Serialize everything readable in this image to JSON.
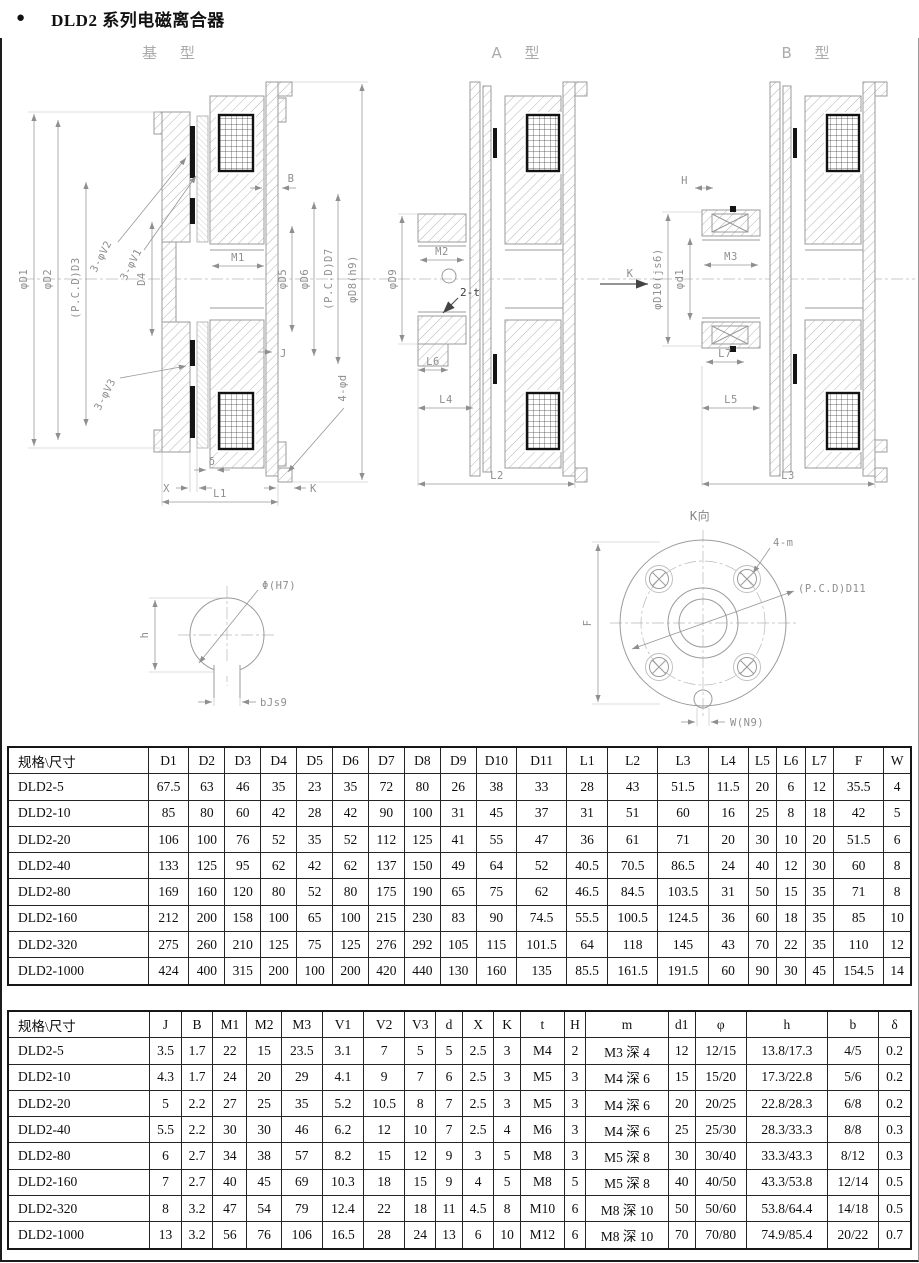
{
  "page": {
    "bullet": "●",
    "title": "DLD2 系列电磁离合器"
  },
  "drawings": {
    "base": {
      "title": "基 型",
      "labels": {
        "d1": "φD1",
        "d2": "φD2",
        "d3": "(P.C.D)D3",
        "d4": "D4",
        "v2": "3-φV2",
        "v1": "3-φV1",
        "v3": "3-φV3",
        "b": "B",
        "m1": "M1",
        "d5": "φD5",
        "d6": "φD6",
        "d7": "(P.C.D)D7",
        "d8": "φD8(h9)",
        "j": "J",
        "phid": "4-φd",
        "x": "X",
        "delta": "δ",
        "l1": "L1",
        "k": "K"
      }
    },
    "typeA": {
      "title": "A 型",
      "labels": {
        "d9": "φD9",
        "m2": "M2",
        "t": "2-t",
        "l6": "L6",
        "l4": "L4",
        "l2": "L2",
        "k": "K"
      }
    },
    "typeB": {
      "title": "B 型",
      "labels": {
        "h": "H",
        "d10": "φD10(js6)",
        "d1": "φd1",
        "m3": "M3",
        "l7": "L7",
        "l5": "L5",
        "l3": "L3"
      }
    },
    "shaft_detail": {
      "labels": {
        "phi": "Φ(H7)",
        "h": "h",
        "b": "bJs9"
      }
    },
    "kview": {
      "title": "K向",
      "labels": {
        "m": "4-m",
        "d11": "(P.C.D)D11",
        "f": "F",
        "w": "W(N9)"
      }
    }
  },
  "tables": [
    {
      "columns": [
        "规格\\尺寸",
        "D1",
        "D2",
        "D3",
        "D4",
        "D5",
        "D6",
        "D7",
        "D8",
        "D9",
        "D10",
        "D11",
        "L1",
        "L2",
        "L3",
        "L4",
        "L5",
        "L6",
        "L7",
        "F",
        "W"
      ],
      "rows": [
        [
          "DLD2-5",
          "67.5",
          "63",
          "46",
          "35",
          "23",
          "35",
          "72",
          "80",
          "26",
          "38",
          "33",
          "28",
          "43",
          "51.5",
          "11.5",
          "20",
          "6",
          "12",
          "35.5",
          "4"
        ],
        [
          "DLD2-10",
          "85",
          "80",
          "60",
          "42",
          "28",
          "42",
          "90",
          "100",
          "31",
          "45",
          "37",
          "31",
          "51",
          "60",
          "16",
          "25",
          "8",
          "18",
          "42",
          "5"
        ],
        [
          "DLD2-20",
          "106",
          "100",
          "76",
          "52",
          "35",
          "52",
          "112",
          "125",
          "41",
          "55",
          "47",
          "36",
          "61",
          "71",
          "20",
          "30",
          "10",
          "20",
          "51.5",
          "6"
        ],
        [
          "DLD2-40",
          "133",
          "125",
          "95",
          "62",
          "42",
          "62",
          "137",
          "150",
          "49",
          "64",
          "52",
          "40.5",
          "70.5",
          "86.5",
          "24",
          "40",
          "12",
          "30",
          "60",
          "8"
        ],
        [
          "DLD2-80",
          "169",
          "160",
          "120",
          "80",
          "52",
          "80",
          "175",
          "190",
          "65",
          "75",
          "62",
          "46.5",
          "84.5",
          "103.5",
          "31",
          "50",
          "15",
          "35",
          "71",
          "8"
        ],
        [
          "DLD2-160",
          "212",
          "200",
          "158",
          "100",
          "65",
          "100",
          "215",
          "230",
          "83",
          "90",
          "74.5",
          "55.5",
          "100.5",
          "124.5",
          "36",
          "60",
          "18",
          "35",
          "85",
          "10"
        ],
        [
          "DLD2-320",
          "275",
          "260",
          "210",
          "125",
          "75",
          "125",
          "276",
          "292",
          "105",
          "115",
          "101.5",
          "64",
          "118",
          "145",
          "43",
          "70",
          "22",
          "35",
          "110",
          "12"
        ],
        [
          "DLD2-1000",
          "424",
          "400",
          "315",
          "200",
          "100",
          "200",
          "420",
          "440",
          "130",
          "160",
          "135",
          "85.5",
          "161.5",
          "191.5",
          "60",
          "90",
          "30",
          "45",
          "154.5",
          "14"
        ]
      ]
    },
    {
      "columns": [
        "规格\\尺寸",
        "J",
        "B",
        "M1",
        "M2",
        "M3",
        "V1",
        "V2",
        "V3",
        "d",
        "X",
        "K",
        "t",
        "H",
        "m",
        "d1",
        "φ",
        "h",
        "b",
        "δ"
      ],
      "rows": [
        [
          "DLD2-5",
          "3.5",
          "1.7",
          "22",
          "15",
          "23.5",
          "3.1",
          "7",
          "5",
          "5",
          "2.5",
          "3",
          "M4",
          "2",
          "M3 深 4",
          "12",
          "12/15",
          "13.8/17.3",
          "4/5",
          "0.2"
        ],
        [
          "DLD2-10",
          "4.3",
          "1.7",
          "24",
          "20",
          "29",
          "4.1",
          "9",
          "7",
          "6",
          "2.5",
          "3",
          "M5",
          "3",
          "M4 深 6",
          "15",
          "15/20",
          "17.3/22.8",
          "5/6",
          "0.2"
        ],
        [
          "DLD2-20",
          "5",
          "2.2",
          "27",
          "25",
          "35",
          "5.2",
          "10.5",
          "8",
          "7",
          "2.5",
          "3",
          "M5",
          "3",
          "M4 深 6",
          "20",
          "20/25",
          "22.8/28.3",
          "6/8",
          "0.2"
        ],
        [
          "DLD2-40",
          "5.5",
          "2.2",
          "30",
          "30",
          "46",
          "6.2",
          "12",
          "10",
          "7",
          "2.5",
          "4",
          "M6",
          "3",
          "M4 深 6",
          "25",
          "25/30",
          "28.3/33.3",
          "8/8",
          "0.3"
        ],
        [
          "DLD2-80",
          "6",
          "2.7",
          "34",
          "38",
          "57",
          "8.2",
          "15",
          "12",
          "9",
          "3",
          "5",
          "M8",
          "3",
          "M5 深 8",
          "30",
          "30/40",
          "33.3/43.3",
          "8/12",
          "0.3"
        ],
        [
          "DLD2-160",
          "7",
          "2.7",
          "40",
          "45",
          "69",
          "10.3",
          "18",
          "15",
          "9",
          "4",
          "5",
          "M8",
          "5",
          "M5 深 8",
          "40",
          "40/50",
          "43.3/53.8",
          "12/14",
          "0.5"
        ],
        [
          "DLD2-320",
          "8",
          "3.2",
          "47",
          "54",
          "79",
          "12.4",
          "22",
          "18",
          "11",
          "4.5",
          "8",
          "M10",
          "6",
          "M8 深 10",
          "50",
          "50/60",
          "53.8/64.4",
          "14/18",
          "0.5"
        ],
        [
          "DLD2-1000",
          "13",
          "3.2",
          "56",
          "76",
          "106",
          "16.5",
          "28",
          "24",
          "13",
          "6",
          "10",
          "M12",
          "6",
          "M8 深 10",
          "70",
          "70/80",
          "74.9/85.4",
          "20/22",
          "0.7"
        ]
      ]
    }
  ]
}
